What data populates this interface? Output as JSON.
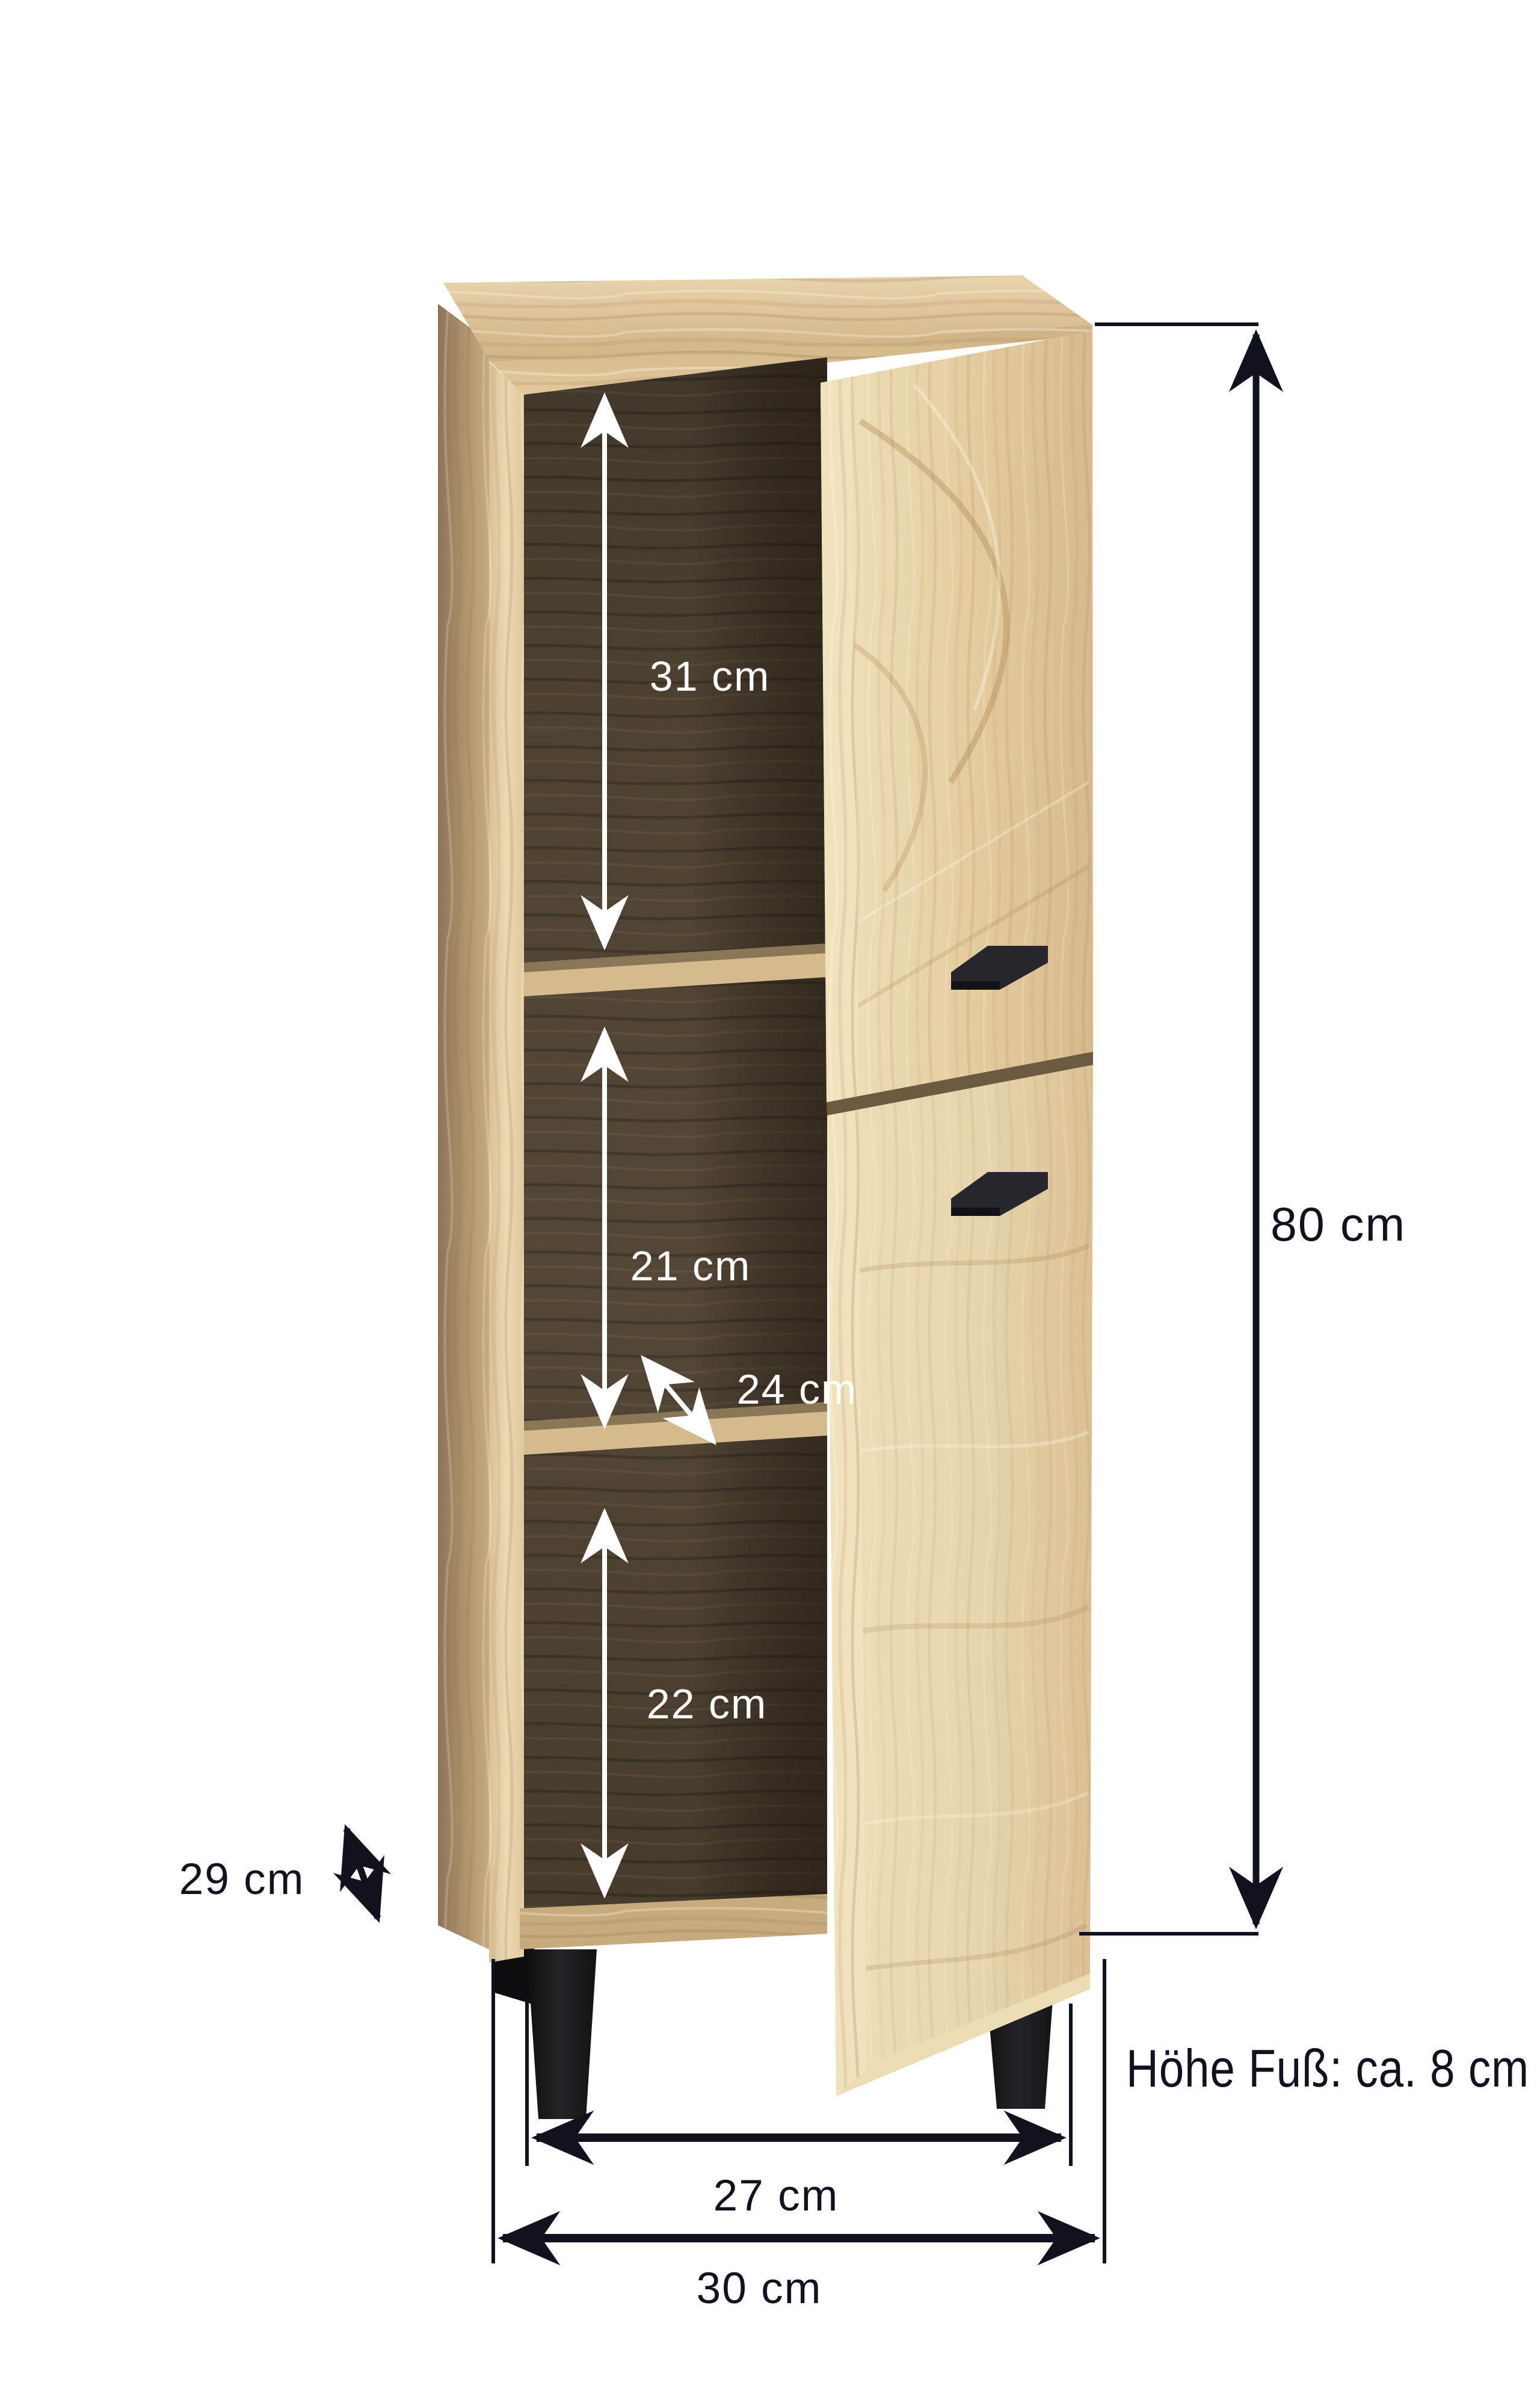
{
  "figure": {
    "kind": "product dimension diagram",
    "subject": "tall bathroom floor cabinet in sonoma oak with open door, two inner shelves, black metal feet and two black handles",
    "background": "#ffffff"
  },
  "dimensions": {
    "compartment_top": "31 cm",
    "compartment_middle": "21 cm",
    "inner_depth": "24 cm",
    "compartment_bottom": "22 cm",
    "total_height": "80 cm",
    "outer_depth": "29 cm",
    "inner_width": "27 cm",
    "total_width": "30 cm",
    "foot_height_note": "Höhe Fuß: ca. 8 cm"
  },
  "colors": {
    "background": "#ffffff",
    "dimension_line_dark": "#10131d",
    "dimension_line_light": "#ffffff",
    "oak_light": "#eadcb6",
    "oak_medium": "#d8bd90",
    "oak_shadow": "#b99d74",
    "interior_dark": "#4a3e2f",
    "shelf_edge": "#d5ba8e",
    "feet_black": "#17171b",
    "handle_black": "#26262c"
  },
  "icons": {
    "arrow_style": "double-headed barbed dimension arrows",
    "white_arrows": [
      "31 cm",
      "21 cm",
      "24 cm",
      "22 cm"
    ],
    "black_arrows": [
      "80 cm",
      "29 cm",
      "27 cm",
      "30 cm"
    ]
  }
}
